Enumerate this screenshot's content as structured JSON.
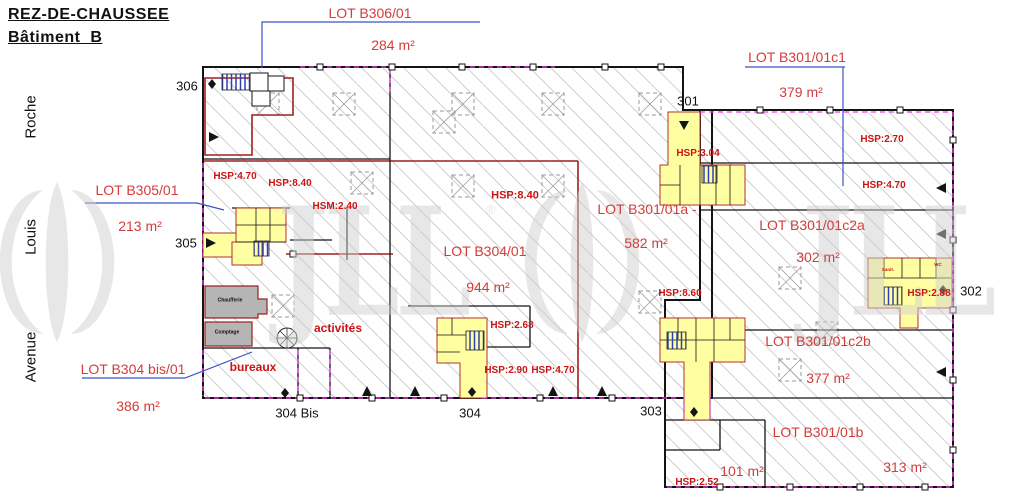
{
  "title": {
    "line1": "REZ-DE-CHAUSSEE",
    "line2": "Bâtiment  B"
  },
  "streets": [
    {
      "name": "Roche"
    },
    {
      "name": "Louis"
    },
    {
      "name": "Avenue"
    }
  ],
  "watermark": {
    "brand": "JLL",
    "reg": "®"
  },
  "lots": [
    {
      "label": "LOT B306/01",
      "area": "284 m²"
    },
    {
      "label": "LOT B305/01",
      "area": "213 m²"
    },
    {
      "label": "LOT B304 bis/01",
      "area": "386 m²"
    },
    {
      "label": "LOT B304/01",
      "area": "944 m²"
    },
    {
      "label": "LOT B301/01a -",
      "area": "582 m²"
    },
    {
      "label": "LOT B301/01c1",
      "area": "379 m²"
    },
    {
      "label": "LOT B301/01c2a",
      "area": "302 m²"
    },
    {
      "label": "LOT B301/01c2b",
      "area": "377 m²"
    },
    {
      "label": "LOT B301/01b",
      "area": "313 m²",
      "area_annex": "101 m²"
    }
  ],
  "heights": [
    {
      "text": "HSP:4.70"
    },
    {
      "text": "HSP:8.40"
    },
    {
      "text": "HSM:2.40"
    },
    {
      "text": "HSP:8.40"
    },
    {
      "text": "HSP:2.70"
    },
    {
      "text": "HSP:4.70"
    },
    {
      "text": "HSP:3.04"
    },
    {
      "text": "HSP:8.60"
    },
    {
      "text": "HSP:2.68"
    },
    {
      "text": "HSP:2.90"
    },
    {
      "text": "HSP:4.70"
    },
    {
      "text": "HSP:2.88"
    },
    {
      "text": "HSP:2.52"
    }
  ],
  "entrances": [
    {
      "label": "306"
    },
    {
      "label": "305"
    },
    {
      "label": "304 Bis"
    },
    {
      "label": "304"
    },
    {
      "label": "303"
    },
    {
      "label": "302"
    },
    {
      "label": "301"
    }
  ],
  "rooms": [
    {
      "label": "Chaufferie"
    },
    {
      "label": "Comptage"
    },
    {
      "label": "activités"
    },
    {
      "label": "bureaux"
    },
    {
      "label": "Sanit."
    },
    {
      "label": "WC"
    }
  ],
  "colors": {
    "lot_label": "#d43c3c",
    "height_label": "#cc1414",
    "leader_line": "#3c50c8",
    "lot_boundary": "#9c2020",
    "wall": "#141414",
    "core_fill": "#ffffa2",
    "stair_blue": "#2d3fb5",
    "magenta": "#f03cf0",
    "hatch": "#cfcfcf",
    "gray_room": "#b5b5b5",
    "watermark": "#cfcfcf"
  }
}
